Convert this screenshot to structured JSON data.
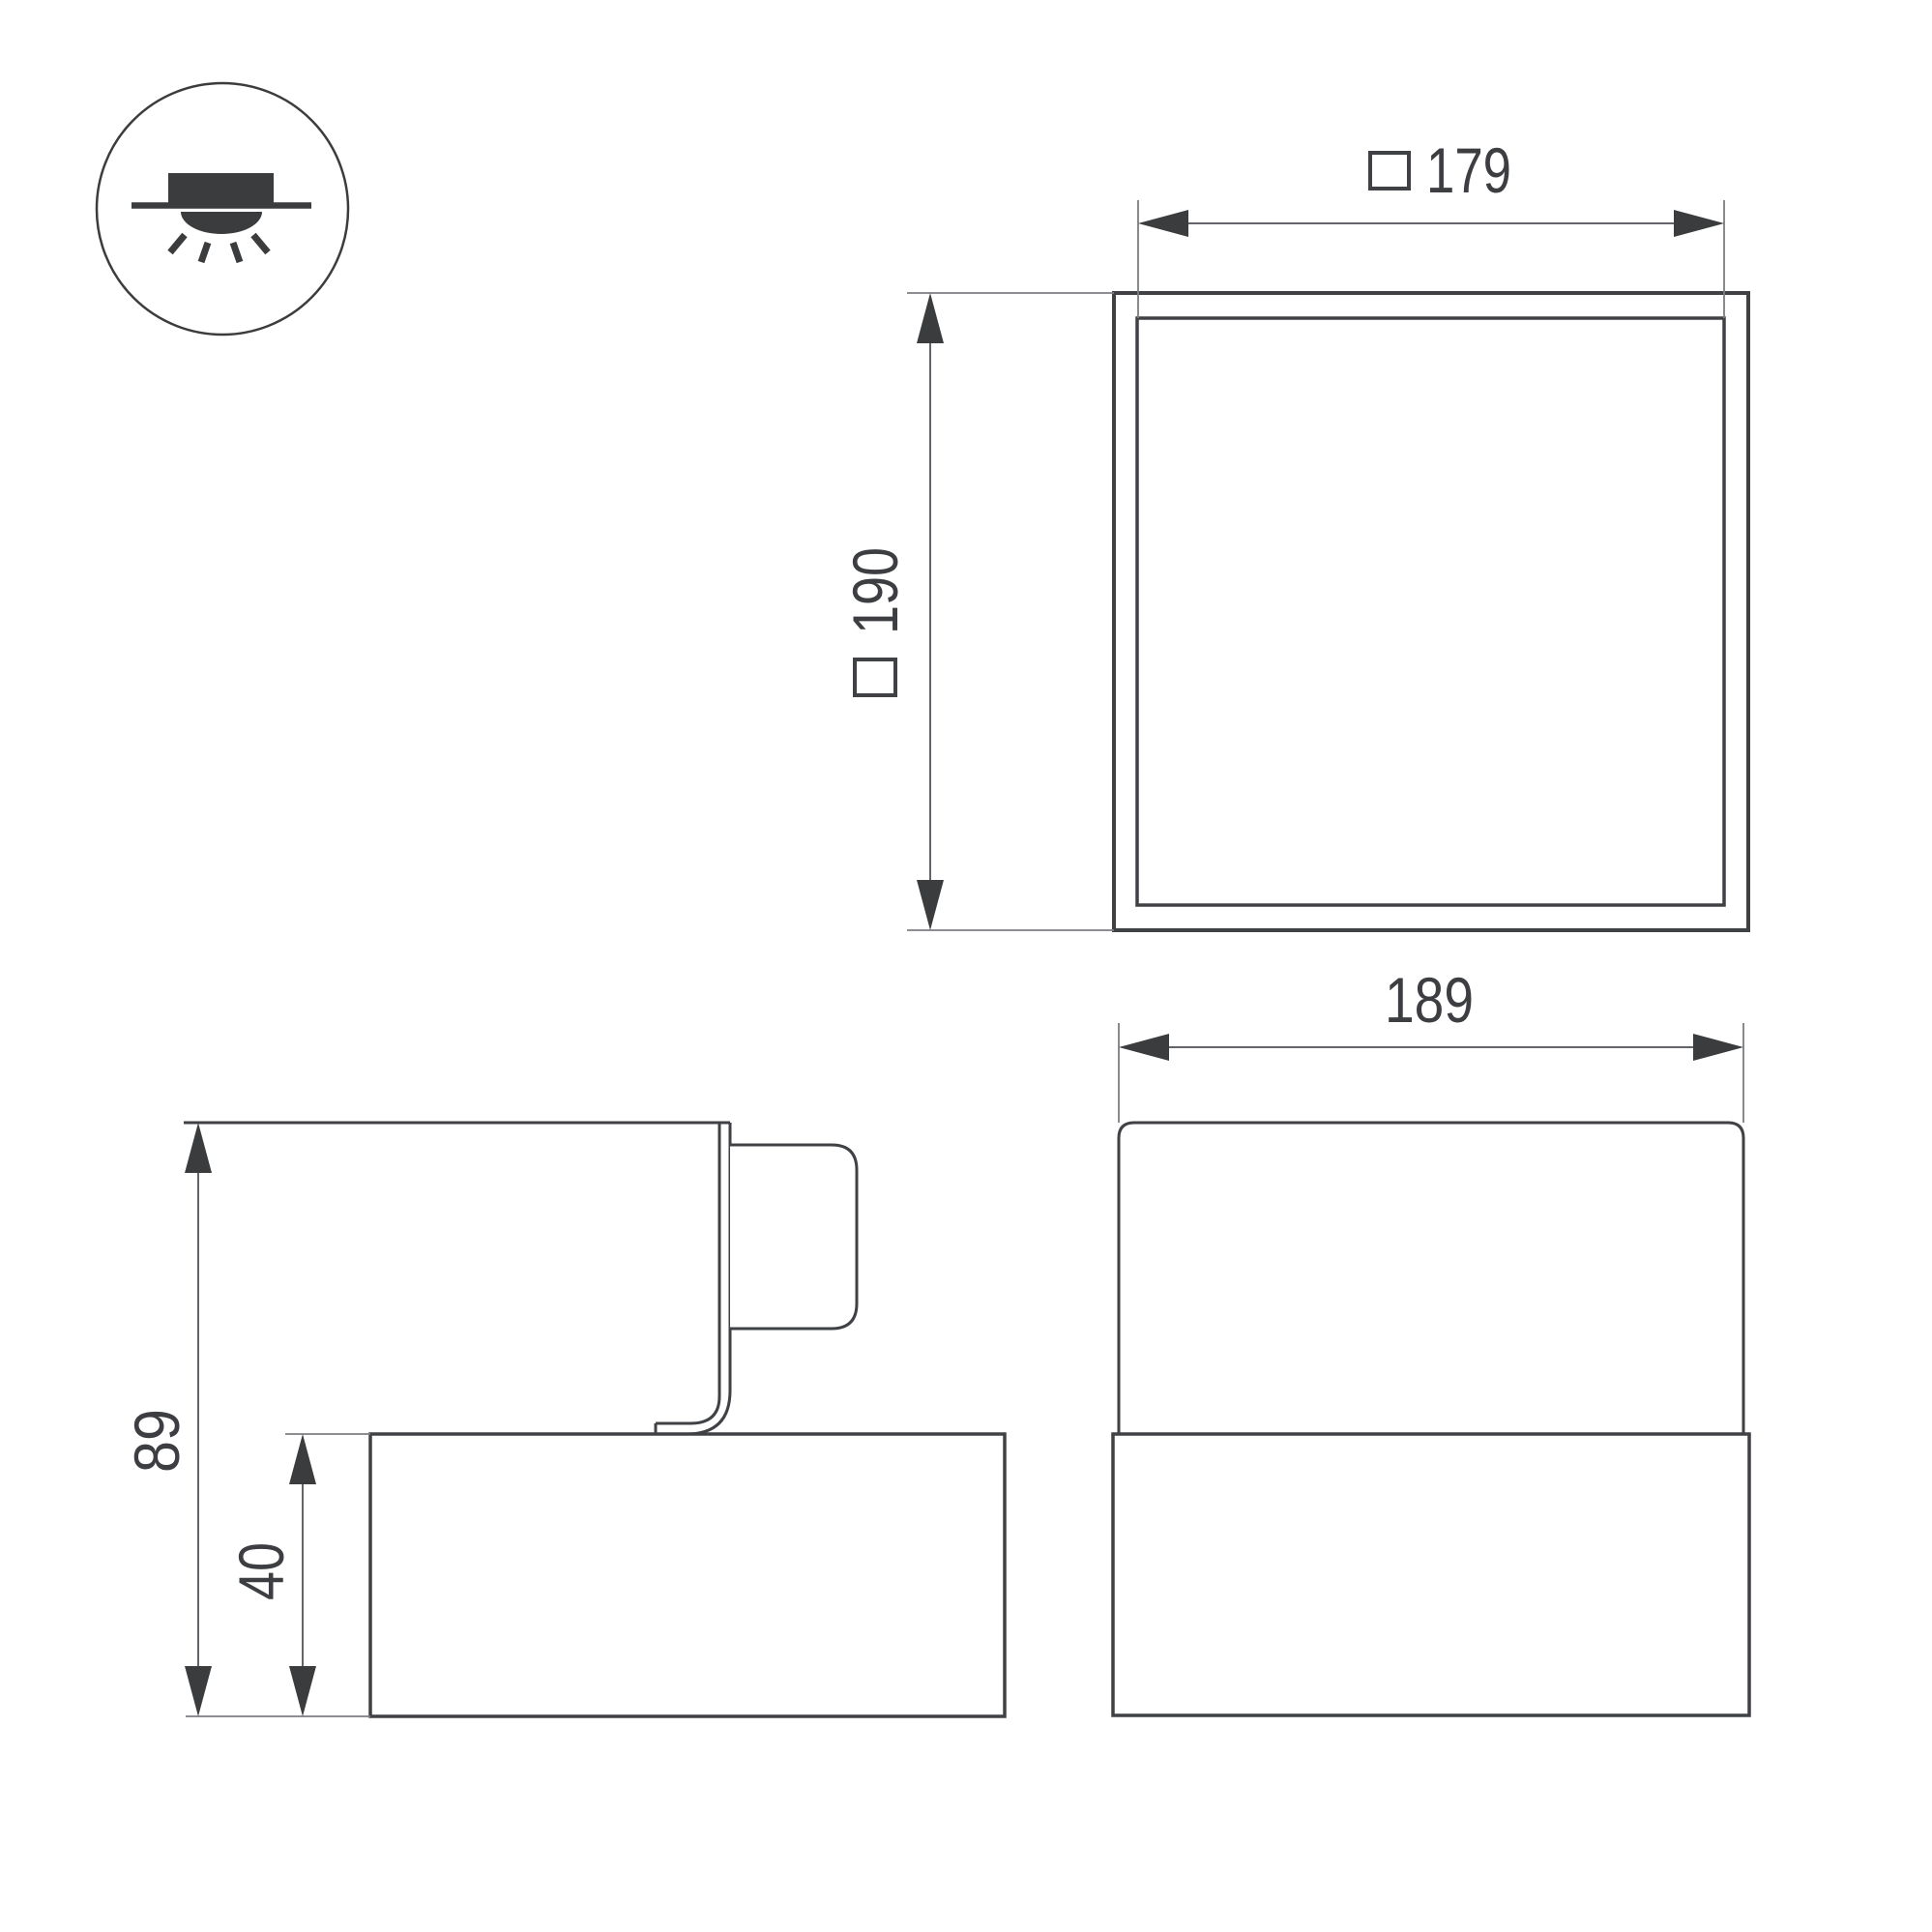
{
  "drawing": {
    "background": "#ffffff",
    "outline_color": "#3f4145",
    "dimension_line_color": "#63656a",
    "text_color": "#3c3e41"
  },
  "mounting_icon": {
    "name": "recessed-ceiling-light-icon"
  },
  "dimensions": {
    "plan_width": {
      "symbol": "□",
      "value": "179"
    },
    "plan_height": {
      "symbol": "□",
      "value": "190"
    },
    "front_width": {
      "value": "189"
    },
    "side_total_height": {
      "value": "89"
    },
    "side_base_height": {
      "value": "40"
    }
  }
}
